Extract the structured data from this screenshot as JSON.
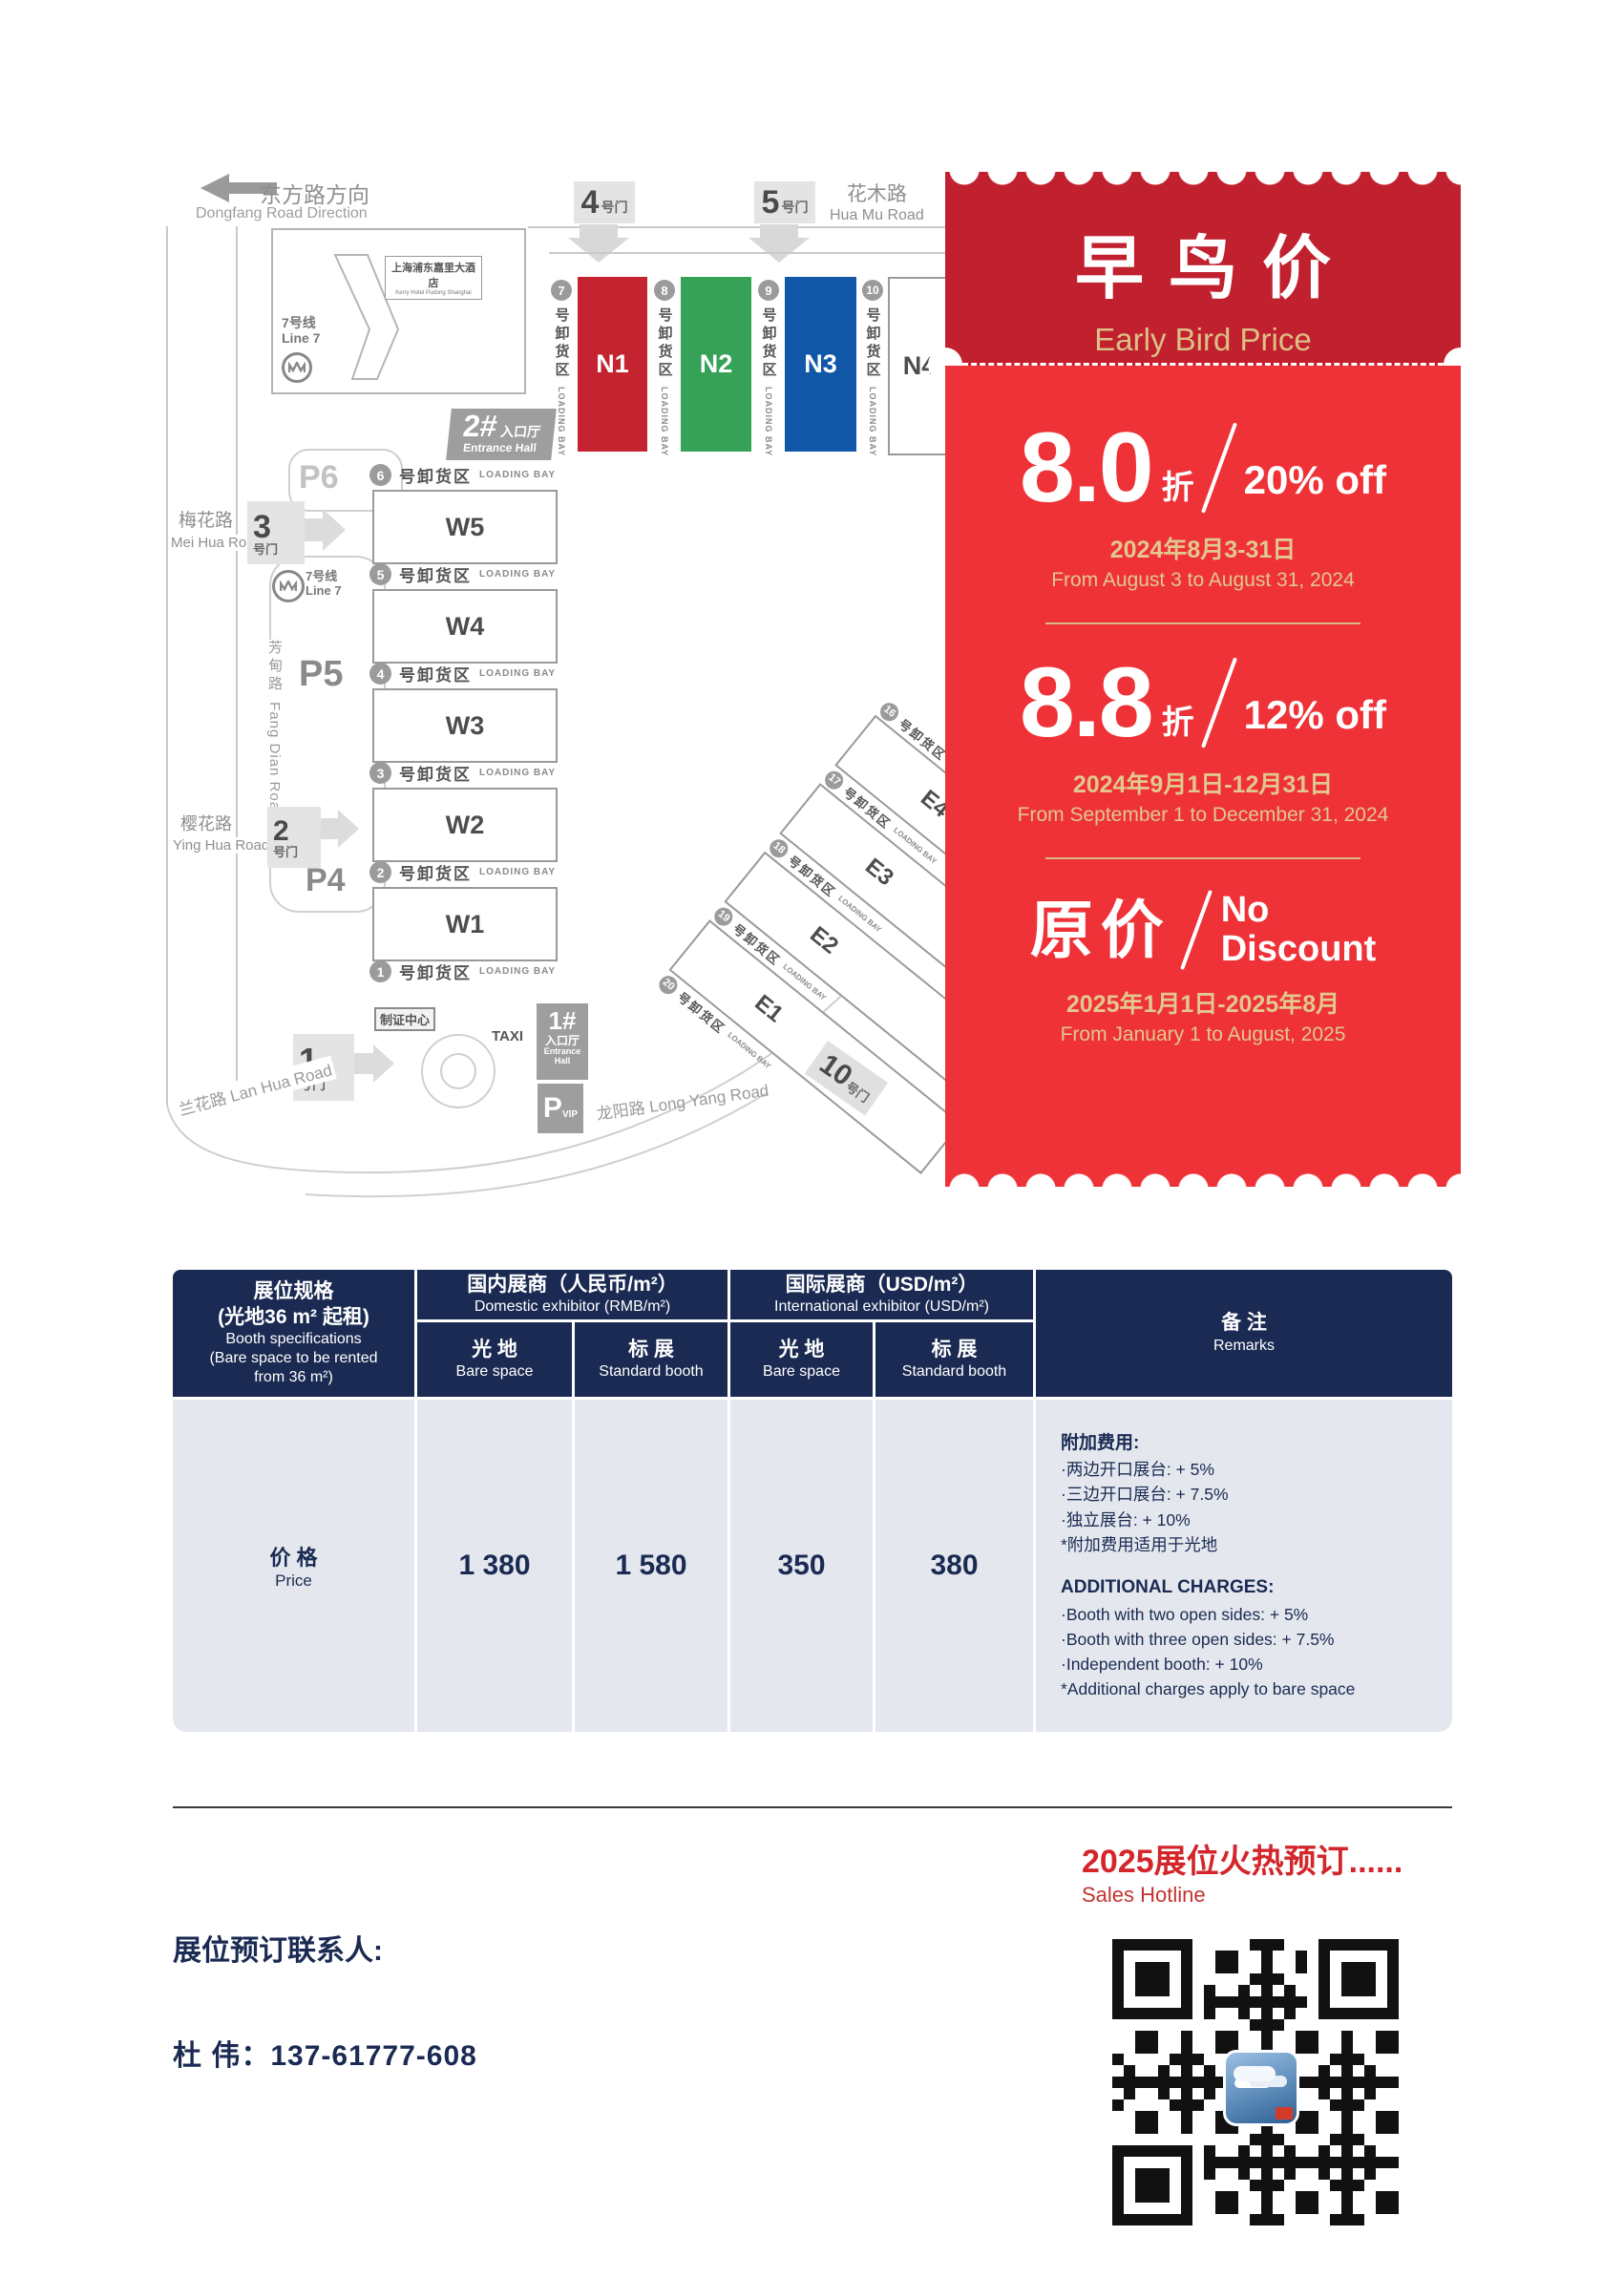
{
  "map": {
    "direction_sign": {
      "cn": "东方路方向",
      "en": "Dongfang Road Direction"
    },
    "roads": {
      "huamu": {
        "cn": "花木路",
        "en": "Hua Mu Road"
      },
      "meihua": {
        "cn": "梅花路",
        "en": "Mei Hua Road"
      },
      "fangdian": {
        "cn": "芳甸路",
        "en": "Fang Dian Road"
      },
      "yinghua": {
        "cn": "樱花路",
        "en": "Ying Hua Road"
      },
      "lanhua": {
        "cn": "兰花路",
        "en": "Lan Hua Road"
      },
      "longyang": {
        "cn": "龙阳路",
        "en": "Long Yang Road"
      }
    },
    "gates": {
      "suffix": "号门",
      "g1": "1",
      "g2": "2",
      "g3": "3",
      "g4": "4",
      "g5": "5",
      "g10": "10"
    },
    "metro": {
      "line_cn": "7号线",
      "line_en": "Line 7"
    },
    "hotel": {
      "cn": "上海浦东嘉里大酒店",
      "en": "Kerry Hotel Pudong Shanghai"
    },
    "entrance2": {
      "num": "2#",
      "cn": "入口厅",
      "en": "Entrance Hall"
    },
    "entrance1": {
      "num": "1#",
      "cn": "入口厅",
      "en": "Entrance Hall"
    },
    "badge_center": "制证中心",
    "taxi": "TAXI",
    "parking": {
      "p4": "P4",
      "p5": "P5",
      "p6": "P6",
      "vip_p": "P",
      "vip_sub": "VIP"
    },
    "halls": {
      "n": [
        "N1",
        "N2",
        "N3",
        "N4"
      ],
      "w": [
        "W5",
        "W4",
        "W3",
        "W2",
        "W1"
      ],
      "e": [
        "E4",
        "E3",
        "E2",
        "E1"
      ]
    },
    "hall_colors": {
      "n1": "#C42430",
      "n2": "#35A257",
      "n3": "#1157A8"
    },
    "loading_bay": {
      "suffix_cn": "号卸货区",
      "en": "LOADING BAY",
      "n_nums": [
        "7",
        "8",
        "9",
        "10"
      ],
      "w_nums": [
        "6",
        "5",
        "4",
        "3",
        "2",
        "1"
      ],
      "e_nums": [
        "16",
        "17",
        "18",
        "19",
        "20"
      ]
    }
  },
  "coupon": {
    "title_cn": "早鸟价",
    "title_en": "Early Bird Price",
    "colors": {
      "header": "#C1202F",
      "body": "#EE3237",
      "gold": "#DCC084"
    },
    "tiers": [
      {
        "big": "8.0",
        "unit": "折",
        "off": "20% off",
        "date_cn": "2024年8月3-31日",
        "date_en": "From August 3 to August 31, 2024"
      },
      {
        "big": "8.8",
        "unit": "折",
        "off": "12% off",
        "date_cn": "2024年9月1日-12月31日",
        "date_en": "From September 1 to December 31, 2024"
      },
      {
        "big": "原价",
        "off_line1": "No",
        "off_line2": "Discount",
        "date_cn": "2025年1月1日-2025年8月",
        "date_en": "From January 1 to August, 2025"
      }
    ]
  },
  "table": {
    "spec_header": {
      "cn1": "展位规格",
      "cn2": "(光地36 m² 起租)",
      "en1": "Booth specifications",
      "en2": "(Bare space to be rented",
      "en3": "from 36 m²)"
    },
    "groups": [
      {
        "cn": "国内展商（人民币/m²）",
        "en": "Domestic exhibitor (RMB/m²)"
      },
      {
        "cn": "国际展商（USD/m²）",
        "en": "International exhibitor (USD/m²)"
      }
    ],
    "subcols": [
      {
        "cn": "光 地",
        "en": "Bare space"
      },
      {
        "cn": "标 展",
        "en": "Standard booth"
      },
      {
        "cn": "光 地",
        "en": "Bare space"
      },
      {
        "cn": "标 展",
        "en": "Standard booth"
      }
    ],
    "remarks_header": {
      "cn": "备 注",
      "en": "Remarks"
    },
    "row": {
      "label_cn": "价 格",
      "label_en": "Price",
      "values": [
        "1 380",
        "1 580",
        "350",
        "380"
      ]
    },
    "remarks": {
      "cn_title": "附加费用:",
      "cn_items": [
        "·两边开口展台: + 5%",
        "·三边开口展台: + 7.5%",
        "·独立展台: + 10%",
        "*附加费用适用于光地"
      ],
      "en_title": "ADDITIONAL CHARGES:",
      "en_items": [
        "·Booth with two open sides: + 5%",
        "·Booth with three open sides: + 7.5%",
        "·Independent booth: + 10%",
        "*Additional charges apply to bare space"
      ]
    }
  },
  "footer": {
    "hotline_cn": "2025展位火热预订......",
    "hotline_en": "Sales Hotline",
    "contact_label": "展位预订联系人:",
    "contact_phone": "杜  伟：137-61777-608"
  }
}
